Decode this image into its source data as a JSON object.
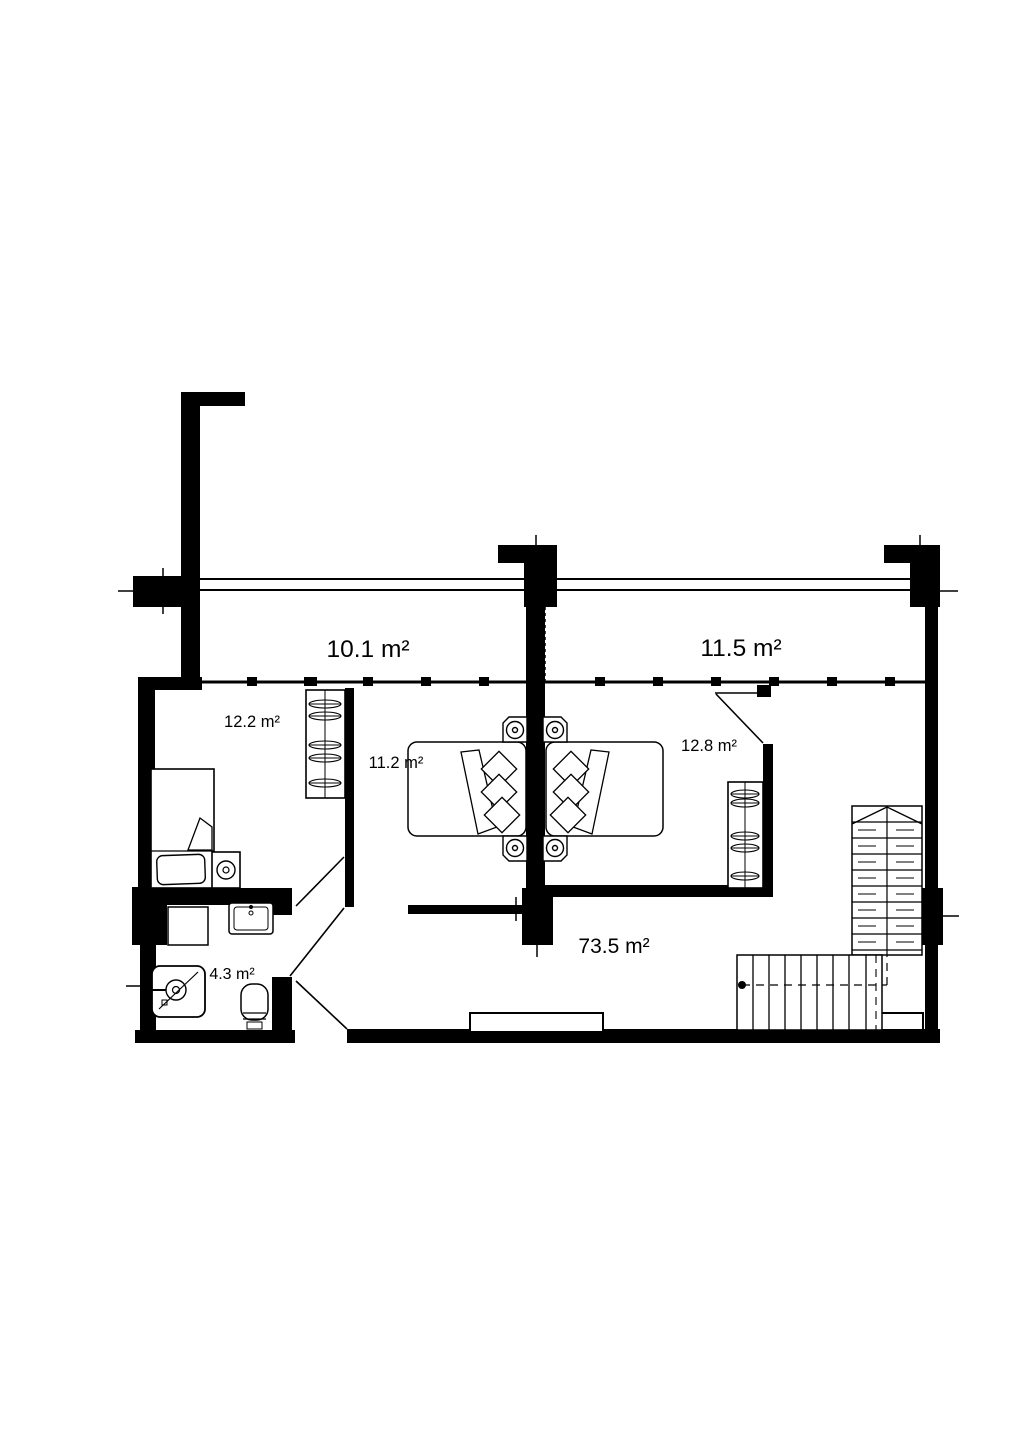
{
  "floor_plan": {
    "unit": "m²",
    "areas": {
      "balcony_left": "10.1 m²",
      "balcony_right": "11.5 m²",
      "bedroom_left": "12.2 m²",
      "bedroom_center": "11.2 m²",
      "bedroom_right": "12.8 m²",
      "living_hall": "73.5 m²",
      "bathroom": "4.3 m²"
    },
    "colors": {
      "walls": "#000000",
      "background": "#ffffff"
    },
    "icons": [
      "single-bed-icon",
      "double-bed-icon",
      "pillow-icon",
      "nightstand-icon",
      "wardrobe-icon",
      "sink-icon",
      "shower-icon",
      "toilet-icon",
      "washing-machine-icon",
      "stairs-icon",
      "door-swing-icon",
      "window-mullion-icon",
      "balcony-railing-icon"
    ]
  }
}
